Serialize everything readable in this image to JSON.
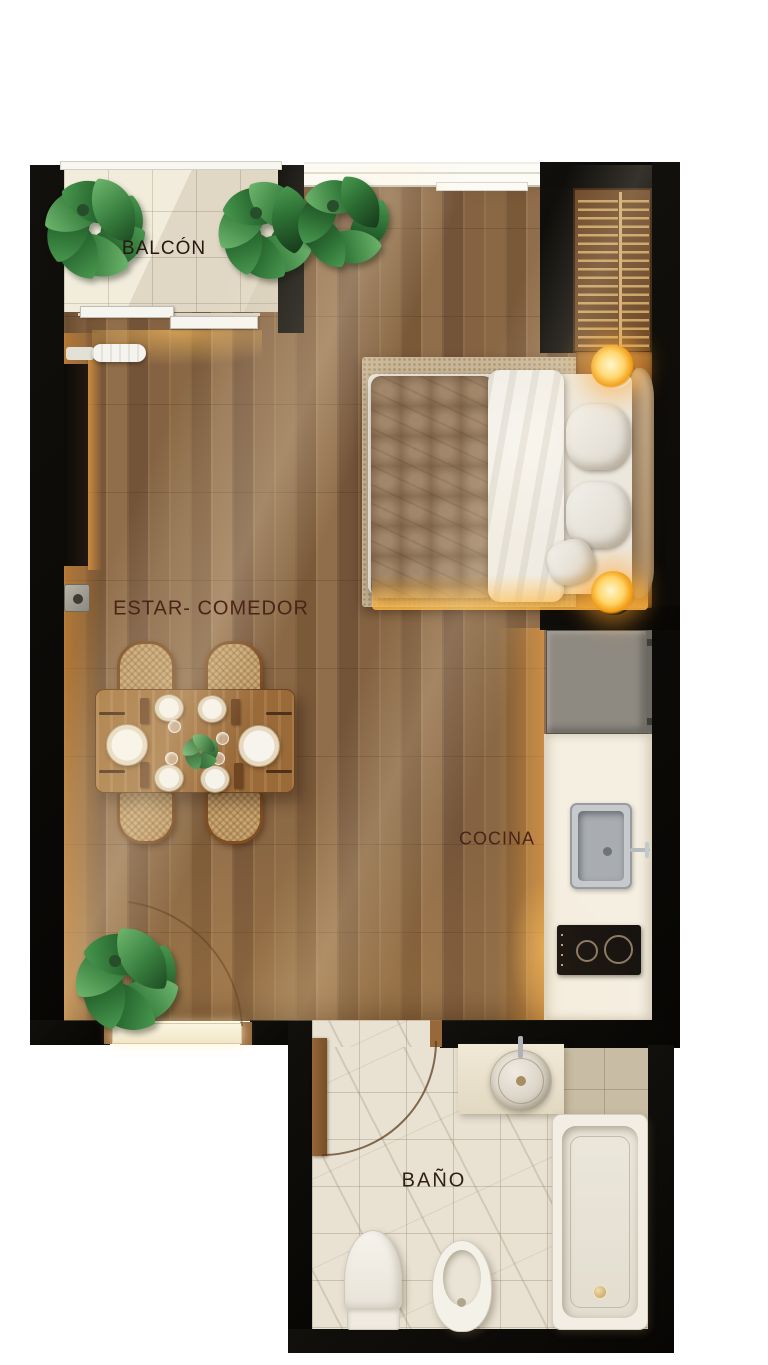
{
  "plan": {
    "type": "apartment-floor-plan",
    "style": "top-down 3d render",
    "rooms": [
      {
        "id": "balcon",
        "label": "BALCÓN"
      },
      {
        "id": "estar_comedor",
        "label": "ESTAR- COMEDOR"
      },
      {
        "id": "cocina",
        "label": "COCINA"
      },
      {
        "id": "bano",
        "label": "BAÑO"
      }
    ],
    "colors": {
      "wall": "#0e0c09",
      "wood_floor": "#82603e",
      "balcony_tile": "#f2ecdc",
      "bath_tile": "#e9e2d3",
      "label_ink": "#3c2016",
      "glow": "#f7a733"
    },
    "furniture": {
      "balcony": [
        "potted-plants",
        "sliding-door"
      ],
      "bedroom": [
        "double-bed",
        "slatted-wardrobe",
        "two-nightstand-lamps",
        "area-rug"
      ],
      "living_dining": [
        "dining-table",
        "four-wicker-chairs",
        "tableware",
        "tv-panel",
        "floor-plant",
        "entrance-door"
      ],
      "kitchen": [
        "tall-cabinet",
        "counter",
        "sink",
        "two-burner-cooktop"
      ],
      "bathroom": [
        "vanity-round-sink",
        "bathtub",
        "toilet",
        "bidet",
        "swing-door"
      ]
    }
  }
}
